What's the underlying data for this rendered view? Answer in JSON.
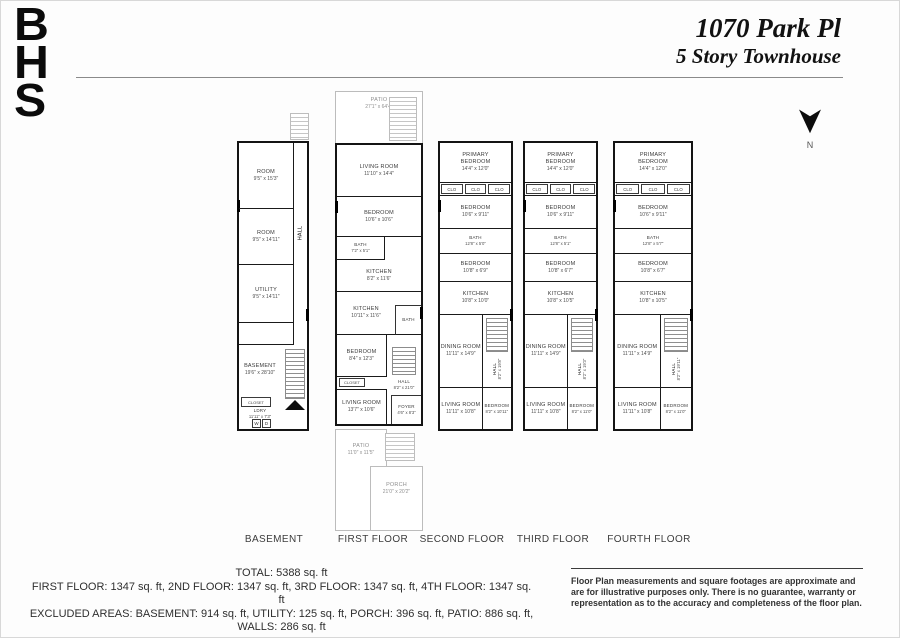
{
  "header": {
    "logo": [
      "B",
      "H",
      "S"
    ],
    "title": "1070 Park Pl",
    "subtitle": "5 Story Townhouse",
    "compass": "N"
  },
  "plans": [
    {
      "label": "BASEMENT",
      "rooms": [
        {
          "name": "ROOM",
          "dims": "9'5\" x 15'3\""
        },
        {
          "name": "ROOM",
          "dims": "9'5\" x 14'11\""
        },
        {
          "name": "UTILITY",
          "dims": "9'5\" x 14'11\""
        },
        {
          "name": "HALL",
          "dims": ""
        },
        {
          "name": "BASEMENT",
          "dims": "19'6\" x 28'10\""
        },
        {
          "name": "CLOSET",
          "dims": ""
        },
        {
          "name": "LDRY",
          "dims": "11'11\" x 7'3\""
        },
        {
          "name": "W",
          "dims": ""
        },
        {
          "name": "D",
          "dims": ""
        }
      ]
    },
    {
      "label": "FIRST FLOOR",
      "outdoor": {
        "patio_top": {
          "name": "PATIO",
          "dims": "27'1\" x 64'4\""
        },
        "patio_bottom": {
          "name": "PATIO",
          "dims": "11'0\" x 11'5\""
        },
        "porch": {
          "name": "PORCH",
          "dims": "21'0\" x 20'2\""
        }
      },
      "rooms": [
        {
          "name": "LIVING ROOM",
          "dims": "11'10\" x 14'4\""
        },
        {
          "name": "BEDROOM",
          "dims": "10'6\" x 10'6\""
        },
        {
          "name": "BATH",
          "dims": "7'2\" x 5'1\""
        },
        {
          "name": "KITCHEN",
          "dims": "8'2\" x 11'6\""
        },
        {
          "name": "KITCHEN",
          "dims": "10'11\" x 11'6\""
        },
        {
          "name": "BATH",
          "dims": ""
        },
        {
          "name": "BEDROOM",
          "dims": "8'4\" x 12'3\""
        },
        {
          "name": "CLOSET",
          "dims": ""
        },
        {
          "name": "HALL",
          "dims": "8'2\" x 21'0\""
        },
        {
          "name": "LIVING ROOM",
          "dims": "13'7\" x 10'6\""
        },
        {
          "name": "FOYER",
          "dims": "4'6\" x 8'3\""
        }
      ]
    },
    {
      "label": "SECOND FLOOR",
      "rooms": [
        {
          "name": "PRIMARY BEDROOM",
          "dims": "14'4\" x 12'0\""
        },
        {
          "name": "CLO"
        },
        {
          "name": "CLO"
        },
        {
          "name": "CLO"
        },
        {
          "name": "BEDROOM",
          "dims": "10'6\" x 9'11\""
        },
        {
          "name": "BATH",
          "dims": "12'8\" x 5'0\""
        },
        {
          "name": "BEDROOM",
          "dims": "10'8\" x 6'9\""
        },
        {
          "name": "KITCHEN",
          "dims": "10'8\" x 10'0\""
        },
        {
          "name": "DINING ROOM",
          "dims": "11'11\" x 14'9\""
        },
        {
          "name": "HALL",
          "dims": "8'2\" x 19'8\""
        },
        {
          "name": "LIVING ROOM",
          "dims": "11'11\" x 10'8\""
        },
        {
          "name": "BEDROOM",
          "dims": "8'2\" x 10'11\""
        }
      ]
    },
    {
      "label": "THIRD FLOOR",
      "rooms": [
        {
          "name": "PRIMARY BEDROOM",
          "dims": "14'4\" x 12'0\""
        },
        {
          "name": "CLO"
        },
        {
          "name": "CLO"
        },
        {
          "name": "CLO"
        },
        {
          "name": "BEDROOM",
          "dims": "10'6\" x 9'11\""
        },
        {
          "name": "BATH",
          "dims": "12'8\" x 5'1\""
        },
        {
          "name": "BEDROOM",
          "dims": "10'8\" x 6'7\""
        },
        {
          "name": "KITCHEN",
          "dims": "10'8\" x 10'5\""
        },
        {
          "name": "DINING ROOM",
          "dims": "11'11\" x 14'9\""
        },
        {
          "name": "HALL",
          "dims": "8'2\" x 19'3\""
        },
        {
          "name": "LIVING ROOM",
          "dims": "11'11\" x 10'8\""
        },
        {
          "name": "BEDROOM",
          "dims": "8'2\" x 11'0\""
        }
      ]
    },
    {
      "label": "FOURTH FLOOR",
      "rooms": [
        {
          "name": "PRIMARY BEDROOM",
          "dims": "14'4\" x 12'0\""
        },
        {
          "name": "CLO"
        },
        {
          "name": "CLO"
        },
        {
          "name": "CLO"
        },
        {
          "name": "BEDROOM",
          "dims": "10'6\" x 9'11\""
        },
        {
          "name": "BATH",
          "dims": "12'8\" x 5'7\""
        },
        {
          "name": "BEDROOM",
          "dims": "10'8\" x 6'7\""
        },
        {
          "name": "KITCHEN",
          "dims": "10'8\" x 10'5\""
        },
        {
          "name": "DINING ROOM",
          "dims": "11'11\" x 14'9\""
        },
        {
          "name": "HALL",
          "dims": "8'2\" x 19'11\""
        },
        {
          "name": "LIVING ROOM",
          "dims": "11'11\" x 10'8\""
        },
        {
          "name": "BEDROOM",
          "dims": "8'2\" x 11'0\""
        }
      ]
    }
  ],
  "footer": {
    "total": "TOTAL: 5388 sq. ft",
    "floors": "FIRST FLOOR: 1347 sq. ft, 2ND FLOOR: 1347 sq. ft, 3RD FLOOR: 1347 sq. ft, 4TH FLOOR: 1347 sq. ft",
    "excluded": "EXCLUDED AREAS: BASEMENT: 914 sq. ft, UTILITY: 125 sq. ft, PORCH: 396 sq. ft, PATIO: 886 sq. ft, WALLS: 286 sq. ft",
    "disclaimer": "Floor Plan measurements and square footages are approximate and are for illustrative purposes only. There is no guarantee, warranty or representation as to the accuracy and completeness of the floor plan."
  }
}
